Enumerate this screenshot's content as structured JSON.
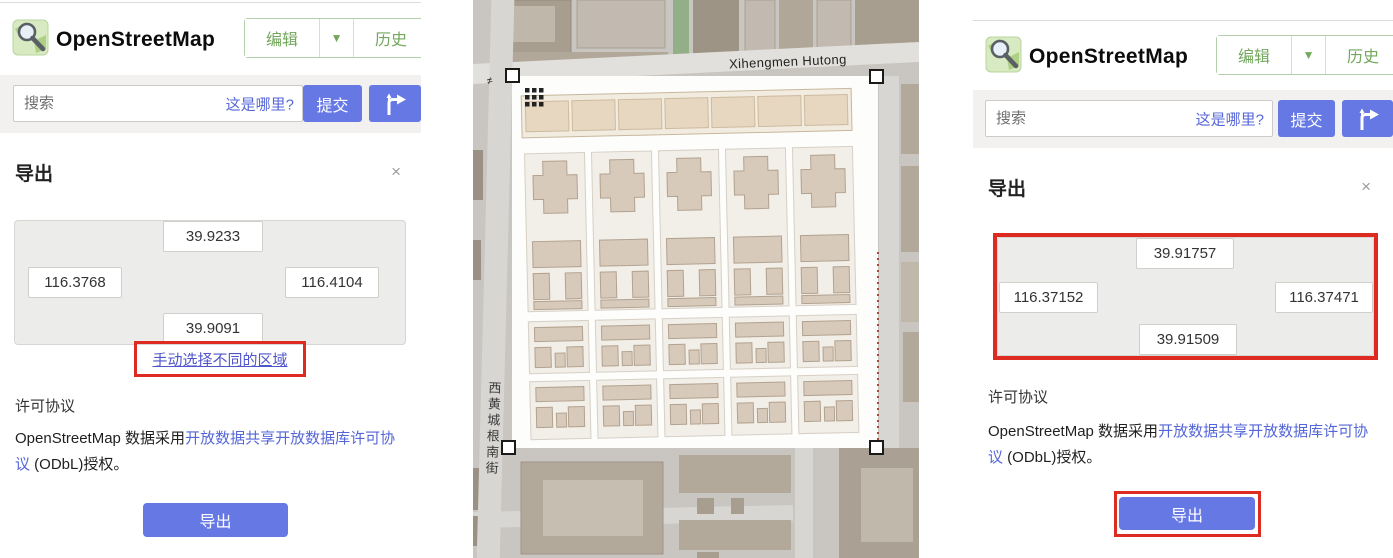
{
  "colors": {
    "accent_blue": "#6678e4",
    "link_blue": "#5566d8",
    "brand_green": "#72a75c",
    "highlight_red": "#dd2b22"
  },
  "ui": {
    "close_glyph": "×",
    "caret_glyph": "▼",
    "gate_glyph": "≠"
  },
  "left_panel": {
    "brand": "OpenStreetMap",
    "nav": {
      "edit_label": "编辑",
      "history_label": "历史"
    },
    "search": {
      "placeholder": "搜索",
      "where_is_this": "这是哪里?",
      "submit_label": "提交"
    },
    "export": {
      "title": "导出",
      "bbox": {
        "north": "39.9233",
        "west": "116.3768",
        "east": "116.4104",
        "south": "39.9091"
      },
      "select_area_link": "手动选择不同的区域",
      "license_heading": "许可协议",
      "license_prefix": "OpenStreetMap 数据采用",
      "license_link": "开放数据共享开放数据库许可协议",
      "license_suffix": " (ODbL)授权。",
      "export_button": "导出"
    }
  },
  "map": {
    "street_top": "Xihengmen Hutong",
    "street_left": "西黄城根南街"
  },
  "right_panel": {
    "brand": "OpenStreetMap",
    "nav": {
      "edit_label": "编辑",
      "history_label": "历史"
    },
    "search": {
      "placeholder": "搜索",
      "where_is_this": "这是哪里?",
      "submit_label": "提交"
    },
    "export": {
      "title": "导出",
      "bbox": {
        "north": "39.91757",
        "west": "116.37152",
        "east": "116.37471",
        "south": "39.91509"
      },
      "license_heading": "许可协议",
      "license_prefix": "OpenStreetMap 数据采用",
      "license_link": "开放数据共享开放数据库许可协议",
      "license_suffix": " (ODbL)授权。",
      "export_button": "导出"
    }
  }
}
